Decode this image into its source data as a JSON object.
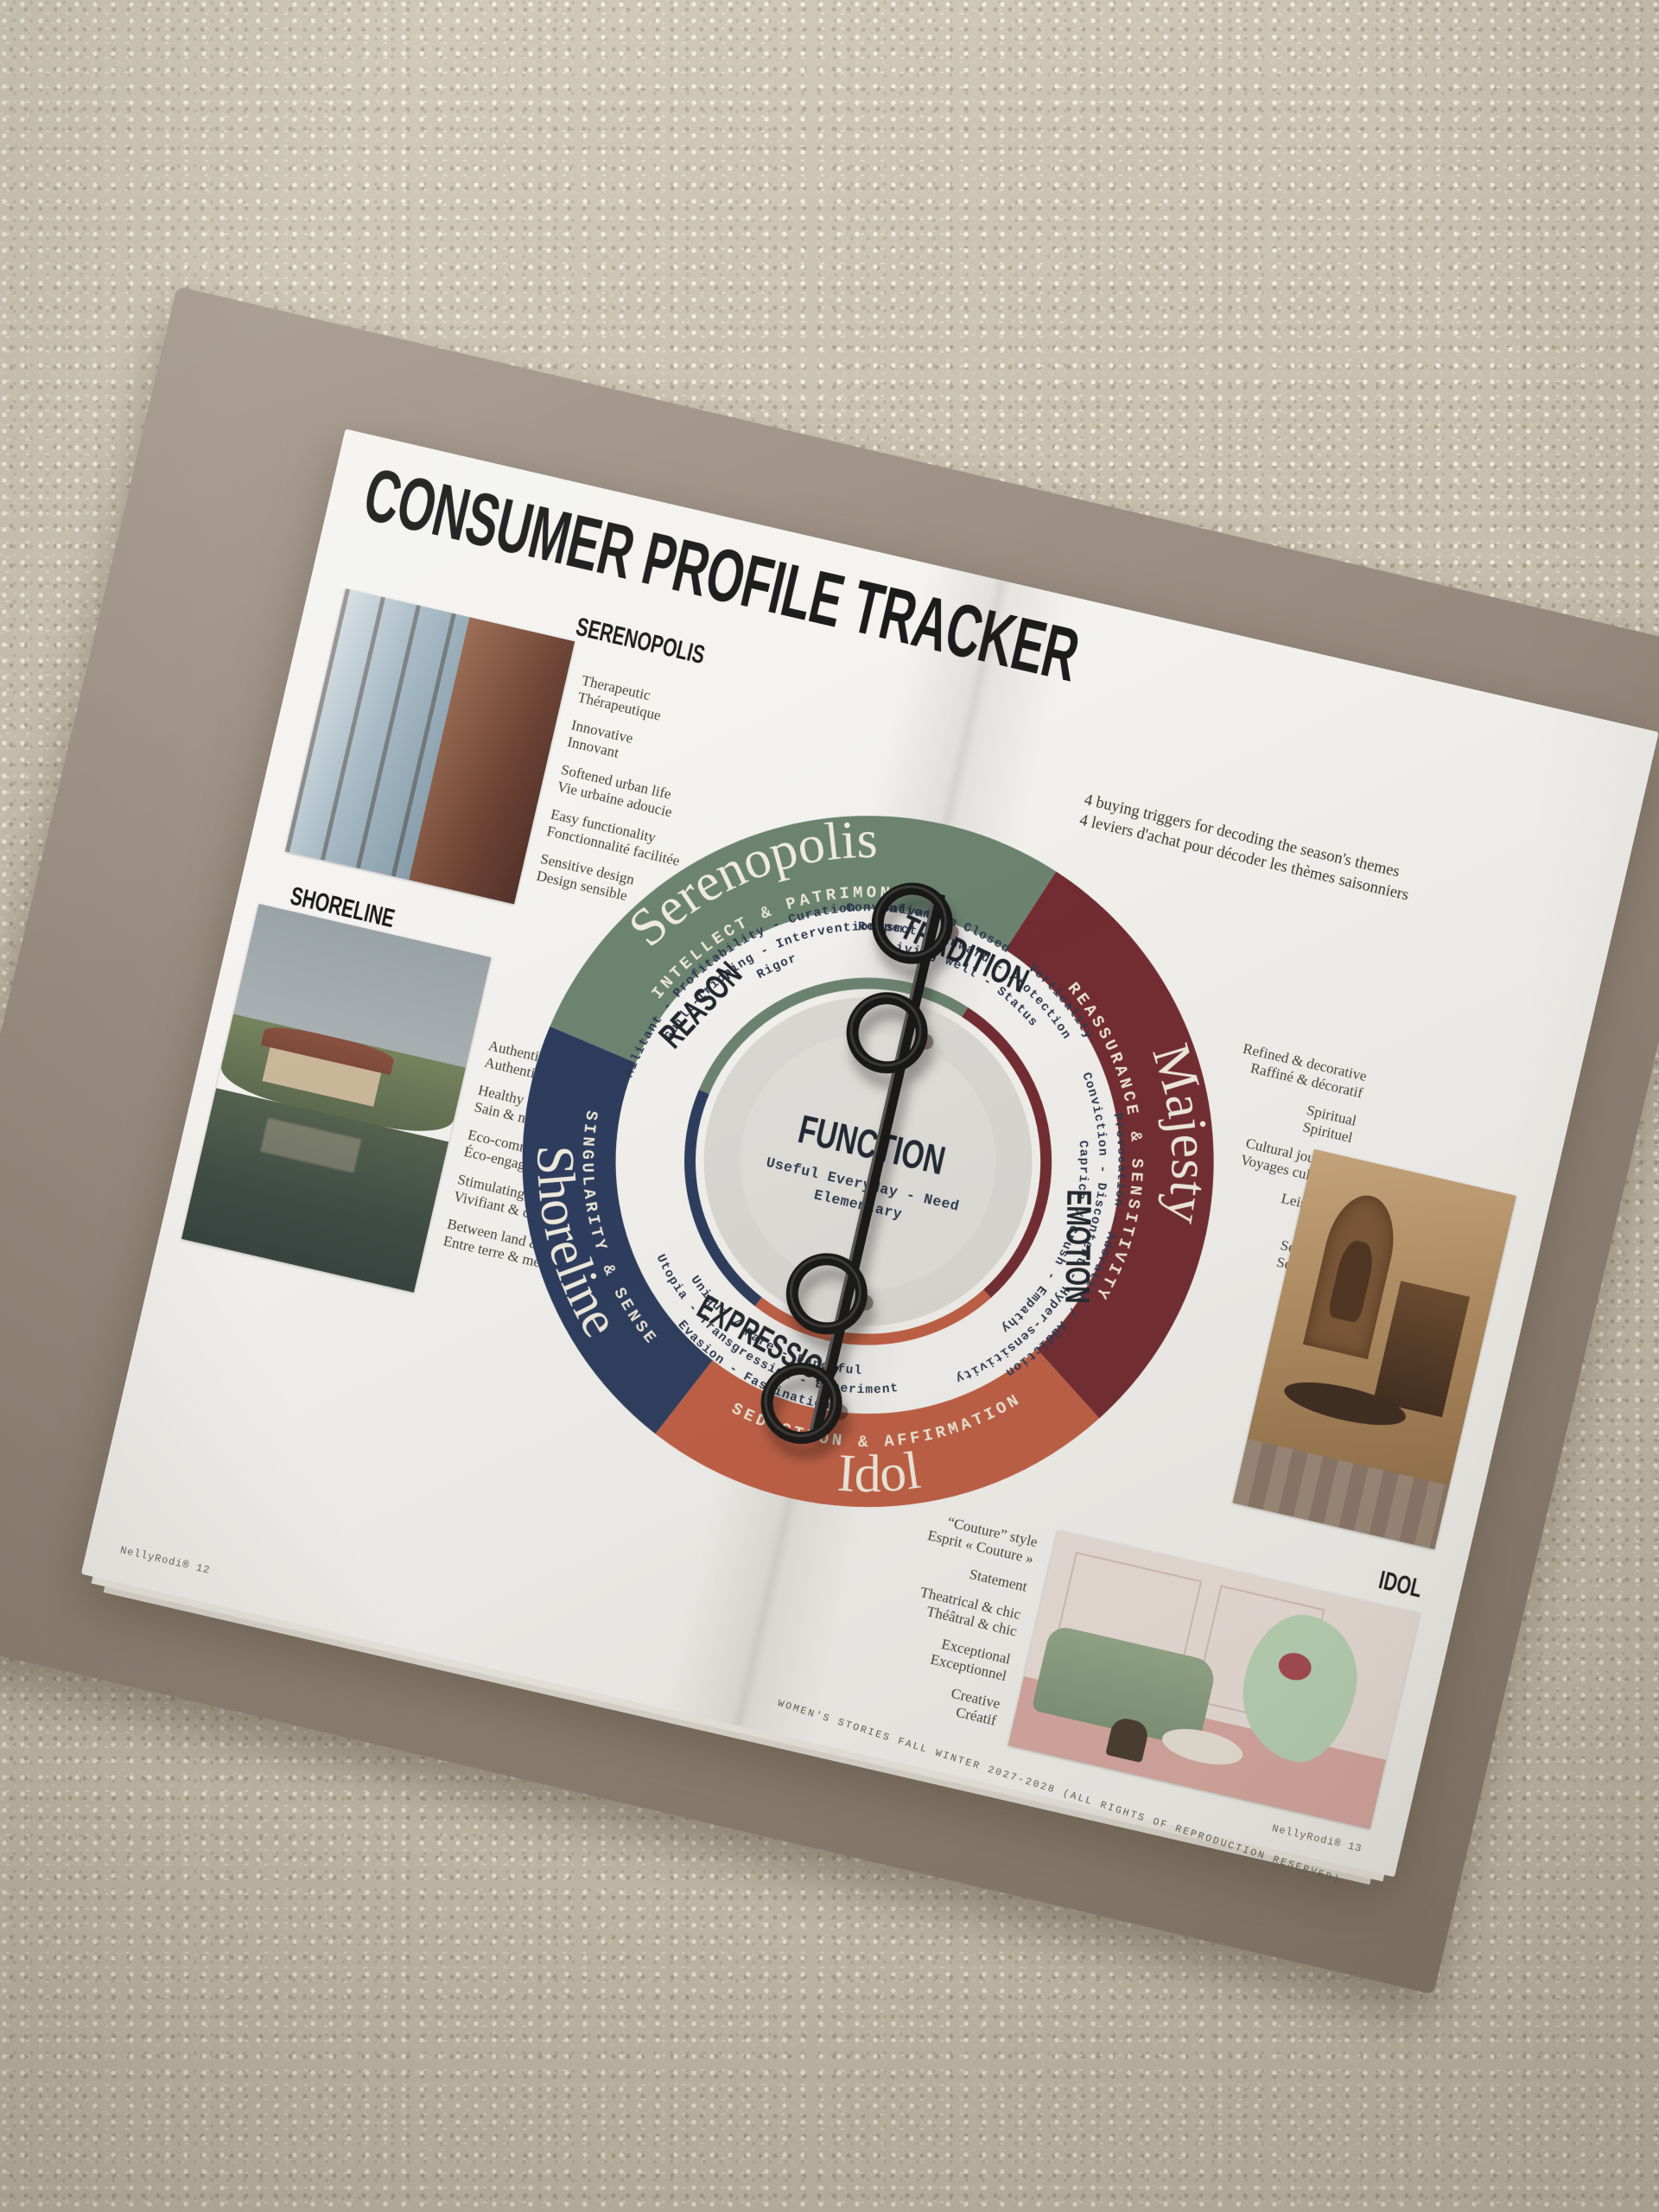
{
  "colors": {
    "carpet": "#c9c1af",
    "binder_cover": "#97897c",
    "page": "#f4f3f0",
    "green": "#6c8471",
    "navy": "#2c3c5e",
    "maroon": "#722b31",
    "orange": "#c05f45",
    "center_gray": "#dbdad6",
    "ink": "#1b1b1b",
    "mono_ink": "#2c3850"
  },
  "left_page": {
    "title": "CONSUMER PROFILE TRACKER",
    "serenopolis": {
      "label": "SERENOPOLIS",
      "photo_alt": "warm interior with tall window",
      "traits": [
        {
          "en": "Therapeutic",
          "fr": "Thérapeutique"
        },
        {
          "en": "Innovative",
          "fr": "Innovant"
        },
        {
          "en": "Softened urban life",
          "fr": "Vie urbaine adoucie"
        },
        {
          "en": "Easy functionality",
          "fr": "Fonctionnalité facilitée"
        },
        {
          "en": "Sensitive design",
          "fr": "Design sensible"
        }
      ]
    },
    "shoreline": {
      "label": "SHORELINE",
      "photo_alt": "stone house by a pond with trees",
      "traits": [
        {
          "en": "Authentic",
          "fr": "Authentique"
        },
        {
          "en": "Healthy & natural",
          "fr": "Sain & naturel"
        },
        {
          "en": "Eco-committed",
          "fr": "Éco-engagé"
        },
        {
          "en": "Stimulating & charming",
          "fr": "Vivifiant & charmant"
        },
        {
          "en": "Between land & sea",
          "fr": "Entre terre & mer"
        }
      ]
    },
    "footer": "NellyRodi® 12"
  },
  "right_page": {
    "intro": {
      "en": "4 buying triggers for decoding the season's themes",
      "fr": "4 leviers d'achat pour décoder les thèmes saisonniers"
    },
    "majesty_photo_alt": "ochre classical interior with arched niche",
    "majesty_traits": [
      {
        "en": "Refined & decorative",
        "fr": "Raffiné & décoratif"
      },
      {
        "en": "Spiritual",
        "fr": "Spirituel"
      },
      {
        "en": "Cultural journeys",
        "fr": "Voyages culturels"
      },
      {
        "en": "Leisurely",
        "fr": "Lent"
      },
      {
        "en": "Sensual",
        "fr": "Sensuel"
      }
    ],
    "idol_label": "IDOL",
    "idol_photo_alt": "pink salon with green sofa and mint sculpture",
    "idol_traits": [
      {
        "en": "“Couture” style",
        "fr": "Esprit « Couture »"
      },
      {
        "en": "Statement",
        "fr": ""
      },
      {
        "en": "Theatrical & chic",
        "fr": "Théâtral & chic"
      },
      {
        "en": "Exceptional",
        "fr": "Exceptionnel"
      },
      {
        "en": "Creative",
        "fr": "Créatif"
      }
    ],
    "spine_credit": "WOMEN'S STORIES FALL WINTER 2027-2028 (ALL RIGHTS OF REPRODUCTION RESERVED)",
    "footer": "NellyRodi® 13"
  },
  "wheel": {
    "center": {
      "label": "FUNCTION",
      "line1": "Useful Everyday - Need",
      "line2": "Elementary"
    },
    "segments": [
      {
        "name": "Serenopolis",
        "subtitle": "INTELLECT & PATRIMONY",
        "color": "#6c8471"
      },
      {
        "name": "Majesty",
        "subtitle": "REASSURANCE & SENSITIVITY",
        "color": "#722b31"
      },
      {
        "name": "Idol",
        "subtitle": "SEDUCTION & AFFIRMATION",
        "color": "#c05f45"
      },
      {
        "name": "Shoreline",
        "subtitle": "SINGULARITY & SENSE",
        "color": "#2c3c5e"
      }
    ],
    "quadrants": [
      {
        "label": "REASON",
        "lines": [
          "Militant - Profitability - Curation - Salvation",
          "Guilt-tripping - Interventionism",
          "Rigor"
        ]
      },
      {
        "label": "TRADITION",
        "lines": [
          "Conventions - Closed - Verticality",
          "Respect - Inward - Protection",
          "Living well - Status"
        ]
      },
      {
        "label": "EMOTION",
        "lines": [
          "Provocation - Adoration / Addiction",
          "Conviction - Discontent - Hyper-sensitivity",
          "Caprice / Crush - Empathy"
        ]
      },
      {
        "label": "EXPRESSION",
        "lines": [
          "Evasion - Fascination",
          "Utopia - Transgression - Experiment",
          "Unique / Rare - Fanciful"
        ]
      }
    ]
  }
}
